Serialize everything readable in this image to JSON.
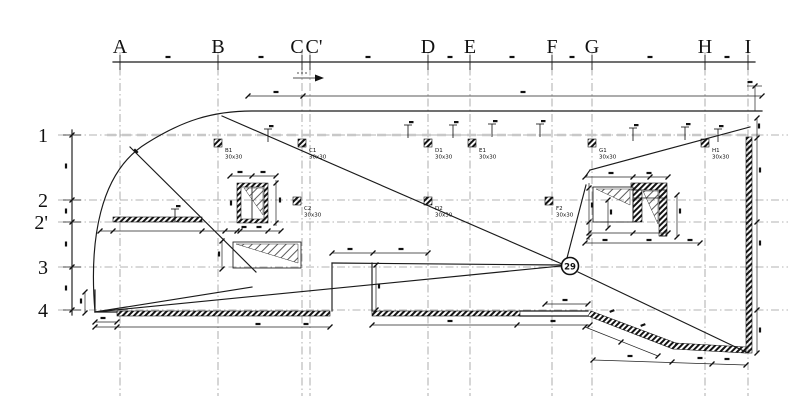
{
  "colors": {
    "line": "#1a1a1a",
    "grid": "#9a9a9a",
    "hatch": "#111111"
  },
  "drawing": {
    "grid_columns": [
      {
        "label": "A"
      },
      {
        "label": "B"
      },
      {
        "label": "C"
      },
      {
        "label": "C'"
      },
      {
        "label": "D"
      },
      {
        "label": "E"
      },
      {
        "label": "F"
      },
      {
        "label": "G"
      },
      {
        "label": "H"
      },
      {
        "label": "I"
      }
    ],
    "grid_rows": [
      {
        "label": "1"
      },
      {
        "label": "2"
      },
      {
        "label": "2'"
      },
      {
        "label": "3"
      },
      {
        "label": "4"
      }
    ],
    "markers": [
      {
        "id": "B1",
        "size": "30x30"
      },
      {
        "id": "C1",
        "size": "30x30"
      },
      {
        "id": "D1",
        "size": "30x30"
      },
      {
        "id": "E1",
        "size": "30x30"
      },
      {
        "id": "G1",
        "size": "30x30"
      },
      {
        "id": "H1",
        "size": "30x30"
      },
      {
        "id": "C2",
        "size": "30x30"
      },
      {
        "id": "D2",
        "size": "30x30"
      },
      {
        "id": "F2",
        "size": "30x30"
      }
    ],
    "node_circle": {
      "label": "29"
    }
  }
}
